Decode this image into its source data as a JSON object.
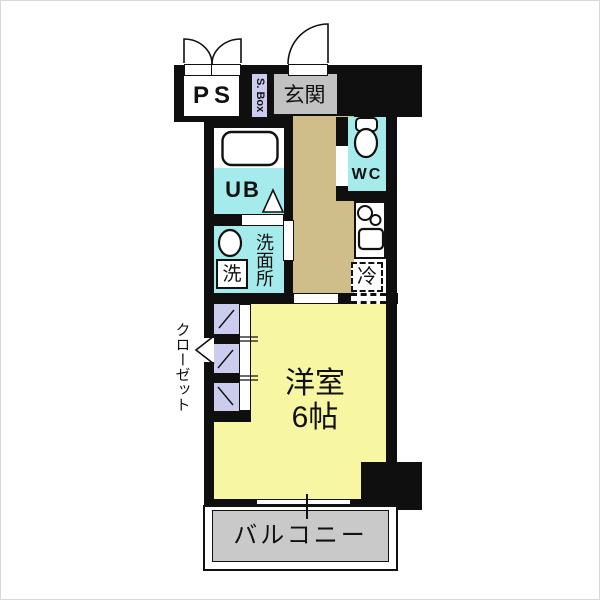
{
  "plan": {
    "type": "japanese-apartment-floor-plan",
    "rooms": {
      "ps": {
        "label": "PS"
      },
      "shoe_box": {
        "label": "S. Box"
      },
      "entrance": {
        "label": "玄関"
      },
      "unit_bath": {
        "label": "UB"
      },
      "toilet": {
        "label": "WC"
      },
      "washroom": {
        "label": "洗面所"
      },
      "washer": {
        "label": "洗"
      },
      "refrigerator": {
        "label": "冷"
      },
      "closet": {
        "label": "クローゼット"
      },
      "western_room": {
        "label": "洋室",
        "size": "6帖"
      },
      "balcony": {
        "label": "バルコニー"
      }
    },
    "colors": {
      "wall": "#0f0f0f",
      "wet_area": "#a5ebeb",
      "hallway_floor": "#cfbd8a",
      "room_floor": "#f7f7a3",
      "closet_floor": "#ccccee",
      "entrance_floor": "#c2c2c2",
      "balcony_floor": "#c9c9c9"
    }
  }
}
